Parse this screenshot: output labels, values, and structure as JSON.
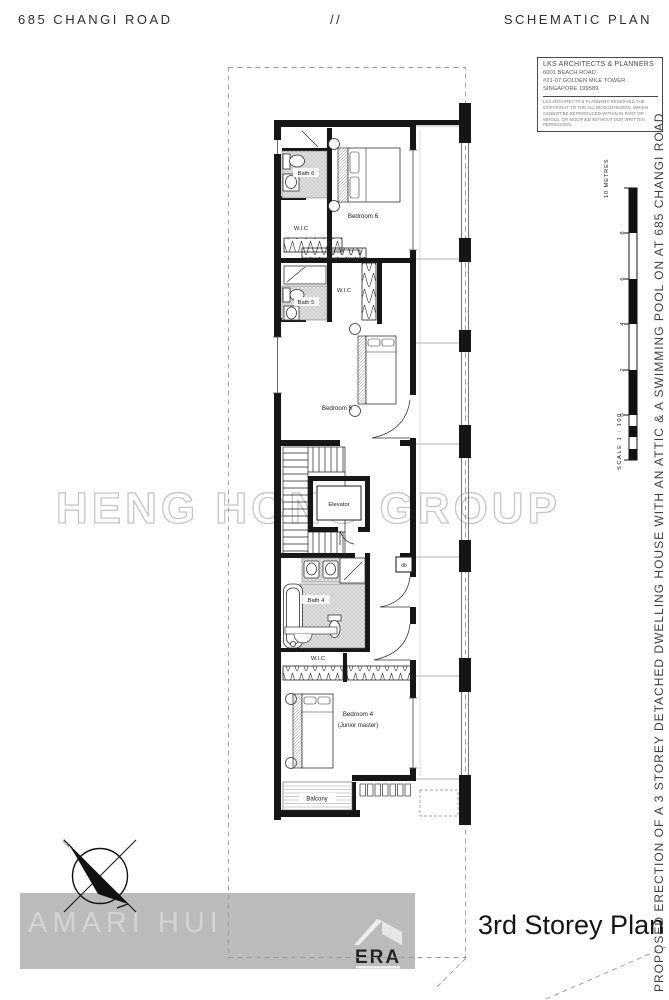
{
  "header": {
    "address": "685 CHANGI ROAD",
    "separator": "//",
    "doc_type": "SCHEMATIC PLAN"
  },
  "title_block": {
    "firm": "LKS ARCHITECTS & PLANNERS",
    "address_line1": "6001 BEACH ROAD",
    "address_line2": "#21-07 GOLDEN MILE TOWER",
    "address_line3": "SINGAPORE 199589",
    "copyright": "LKS ARCHITECTS & PLANNERS RESERVED THE COPYRIGHT TO THE ALL DESIGN HEREIN, WHICH CANNOT BE REPRODUCED WITHIN IN PART OR WHOLE, OR MODIFIED WITHOUT OUR WRITTEN PERMISSION."
  },
  "side_note": "PROPOSED ERECTION OF A 3 STOREY DETACHED DWELLING HOUSE WITH AN ATTIC & A SWIMMING POOL ON AT 685 CHANGI ROAD",
  "plan": {
    "labels": {
      "bath6": "Bath 6",
      "bedroom6": "Bedroom 6",
      "wic_top": "W.I.C",
      "bath5": "Bath 5",
      "wic_mid": "W.I.C",
      "bedroom5": "Bedroom 5",
      "elevator": "Elevator",
      "db": "db",
      "bath4": "Bath 4",
      "wic_bottom": "W.I.C",
      "bedroom4": "Bedroom 4",
      "bedroom4_sub": "(Junior master)",
      "balcony": "Balcony"
    }
  },
  "scale_bar": {
    "top_label": "10 METRES",
    "ticks": [
      "8",
      "6",
      "4",
      "2",
      "0"
    ],
    "scale_label": "SCALE 1 : 100"
  },
  "compass": {
    "label": "NORTH"
  },
  "watermarks": {
    "group_name": "HENG HONG GROUP",
    "agent_name": "AMARI HUI",
    "brand_name": "ERA",
    "brand_tagline": "REAL ESTATE"
  },
  "footer": {
    "plan_title": "3rd Storey Plan"
  },
  "colors": {
    "wall": "#161616",
    "watermark_outline": "#c6c6c6",
    "watermark_band": "#bbbbbb",
    "watermark_text": "#d3d3d3",
    "dashed_border": "#9a9a9a"
  }
}
